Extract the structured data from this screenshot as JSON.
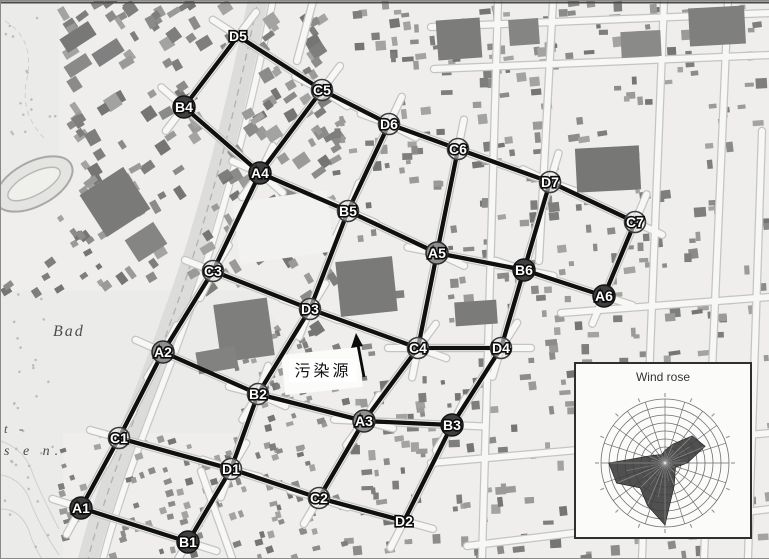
{
  "figure": {
    "pollution_source_label": "污染源",
    "map_place_labels": [
      {
        "text": "Bad"
      },
      {
        "text": "t -"
      },
      {
        "text": "s e n."
      }
    ]
  },
  "network": {
    "nodes": [
      {
        "id": "A1",
        "x": 80,
        "y": 507,
        "variant": "dark"
      },
      {
        "id": "A2",
        "x": 162,
        "y": 351,
        "variant": "mid"
      },
      {
        "id": "A3",
        "x": 363,
        "y": 420,
        "variant": "mid"
      },
      {
        "id": "A4",
        "x": 259,
        "y": 172,
        "variant": "dark"
      },
      {
        "id": "A5",
        "x": 436,
        "y": 252,
        "variant": "mid"
      },
      {
        "id": "A6",
        "x": 603,
        "y": 295,
        "variant": "dark"
      },
      {
        "id": "B1",
        "x": 187,
        "y": 541,
        "variant": "dark"
      },
      {
        "id": "B2",
        "x": 257,
        "y": 393,
        "variant": "light"
      },
      {
        "id": "B3",
        "x": 451,
        "y": 424,
        "variant": "dark"
      },
      {
        "id": "B4",
        "x": 183,
        "y": 106,
        "variant": "dark"
      },
      {
        "id": "B5",
        "x": 347,
        "y": 210,
        "variant": "light"
      },
      {
        "id": "B6",
        "x": 523,
        "y": 269,
        "variant": "dark"
      },
      {
        "id": "C1",
        "x": 118,
        "y": 437,
        "variant": "light"
      },
      {
        "id": "C2",
        "x": 318,
        "y": 497,
        "variant": "light"
      },
      {
        "id": "C3",
        "x": 212,
        "y": 270,
        "variant": "light"
      },
      {
        "id": "C4",
        "x": 417,
        "y": 347,
        "variant": "light"
      },
      {
        "id": "C5",
        "x": 321,
        "y": 89,
        "variant": "light"
      },
      {
        "id": "C6",
        "x": 457,
        "y": 148,
        "variant": "light"
      },
      {
        "id": "C7",
        "x": 634,
        "y": 221,
        "variant": "light"
      },
      {
        "id": "D1",
        "x": 230,
        "y": 468,
        "variant": "light"
      },
      {
        "id": "D2",
        "x": 403,
        "y": 520,
        "variant": "none"
      },
      {
        "id": "D3",
        "x": 309,
        "y": 308,
        "variant": "light"
      },
      {
        "id": "D4",
        "x": 500,
        "y": 347,
        "variant": "light"
      },
      {
        "id": "D5",
        "x": 237,
        "y": 35,
        "variant": "none"
      },
      {
        "id": "D6",
        "x": 388,
        "y": 123,
        "variant": "light"
      },
      {
        "id": "D7",
        "x": 549,
        "y": 181,
        "variant": "light"
      }
    ],
    "edges": [
      [
        "D5",
        "B4"
      ],
      [
        "D5",
        "C5"
      ],
      [
        "B4",
        "A4"
      ],
      [
        "C5",
        "A4"
      ],
      [
        "C5",
        "D6"
      ],
      [
        "D6",
        "C6"
      ],
      [
        "D6",
        "B5"
      ],
      [
        "C6",
        "D7"
      ],
      [
        "C6",
        "A5"
      ],
      [
        "D7",
        "C7"
      ],
      [
        "D7",
        "B6"
      ],
      [
        "C7",
        "A6"
      ],
      [
        "B6",
        "A6"
      ],
      [
        "A5",
        "B6"
      ],
      [
        "B5",
        "A5"
      ],
      [
        "A4",
        "B5"
      ],
      [
        "A4",
        "C3"
      ],
      [
        "B5",
        "D3"
      ],
      [
        "C3",
        "D3"
      ],
      [
        "C3",
        "A2"
      ],
      [
        "D3",
        "C4"
      ],
      [
        "D3",
        "B2"
      ],
      [
        "C4",
        "D4"
      ],
      [
        "C4",
        "A3"
      ],
      [
        "A5",
        "C4"
      ],
      [
        "D4",
        "B6"
      ],
      [
        "D4",
        "B3"
      ],
      [
        "A2",
        "B2"
      ],
      [
        "A2",
        "C1"
      ],
      [
        "B2",
        "D1"
      ],
      [
        "B2",
        "A3"
      ],
      [
        "A3",
        "B3"
      ],
      [
        "A3",
        "C2"
      ],
      [
        "B3",
        "D2"
      ],
      [
        "C2",
        "D2"
      ],
      [
        "D1",
        "C2"
      ],
      [
        "C1",
        "D1"
      ],
      [
        "C1",
        "A1"
      ],
      [
        "A1",
        "B1"
      ],
      [
        "D1",
        "B1"
      ]
    ]
  },
  "chart_data": {
    "type": "wind_rose_polar",
    "title": "Wind rose",
    "directions": [
      "N",
      "NNE",
      "NE",
      "ENE",
      "E",
      "ESE",
      "SE",
      "SSE",
      "S",
      "SSW",
      "SW",
      "WSW",
      "W",
      "WNW",
      "NW",
      "NNW"
    ],
    "magnitudes": [
      0.2,
      0.32,
      0.6,
      0.68,
      0.35,
      0.18,
      0.22,
      0.38,
      0.97,
      0.72,
      0.55,
      0.82,
      0.88,
      0.28,
      0.18,
      0.14
    ],
    "rings": 8,
    "grid": "polar-web",
    "legend_position": "none"
  },
  "colors": {
    "map_bg": "#efeeec",
    "park": "#ebebe9",
    "rail_band": "#dcdcda",
    "building": "#8a8a88",
    "street": "#f7f7f5",
    "street_casing": "#c4c4c2",
    "edge": "#101010",
    "node_dark": "#3f3f3f",
    "node_mid": "#8f8f8f",
    "node_light": "#ebebeb",
    "node_ring": "#2a2a2a",
    "label_text": "#ffffff",
    "label_outline": "#0b0b0b",
    "rose_fill": "#3d3d3d",
    "rose_grid": "#6f6f6f"
  }
}
